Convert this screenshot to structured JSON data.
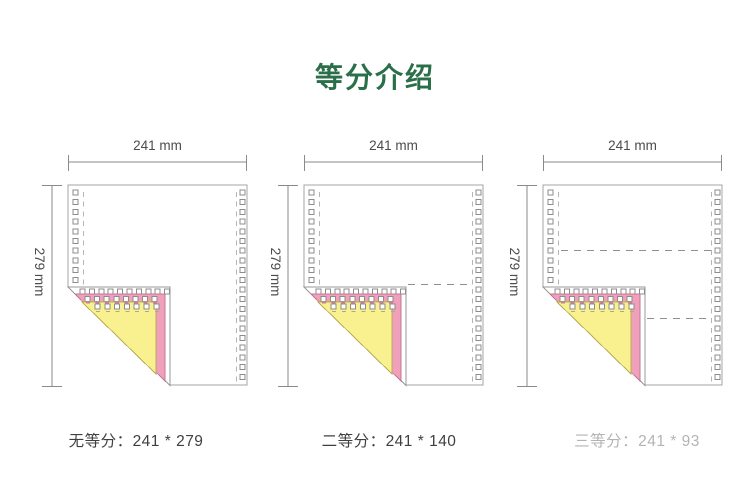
{
  "title": {
    "text": "等分介绍"
  },
  "colors": {
    "title_green": "#2b6f4a",
    "pink": "#f0a0bb",
    "pink_edge": "#c07795",
    "pink_dash": "#d07ba2",
    "yellow": "#f9f08f",
    "yellow_edge": "#b9ac56",
    "yellow_dash": "#b0aa80",
    "sheet_border": "#a6a6a6",
    "fold_edge": "#9a9a9a",
    "hole_border": "#8c8c8c",
    "margin_dash": "#b5b5b5",
    "dim_line": "#8a8a8a",
    "dim_text": "#4c4c4c",
    "division_dash": "#8f8f8f",
    "caption_text": "#3f3f3f"
  },
  "diagrams": [
    {
      "name": "no-division",
      "width_label": "241 mm",
      "height_label": "279 mm",
      "caption": "无等分：241 * 279",
      "divisions": 1,
      "faded_caption": false
    },
    {
      "name": "two-equal-divisions",
      "width_label": "241 mm",
      "height_label": "279 mm",
      "caption": "二等分：241 * 140",
      "divisions": 2,
      "faded_caption": false
    },
    {
      "name": "three-equal-divisions",
      "width_label": "241 mm",
      "height_label": "279 mm",
      "caption": "三等分：241 * 93",
      "divisions": 3,
      "faded_caption": true
    }
  ]
}
